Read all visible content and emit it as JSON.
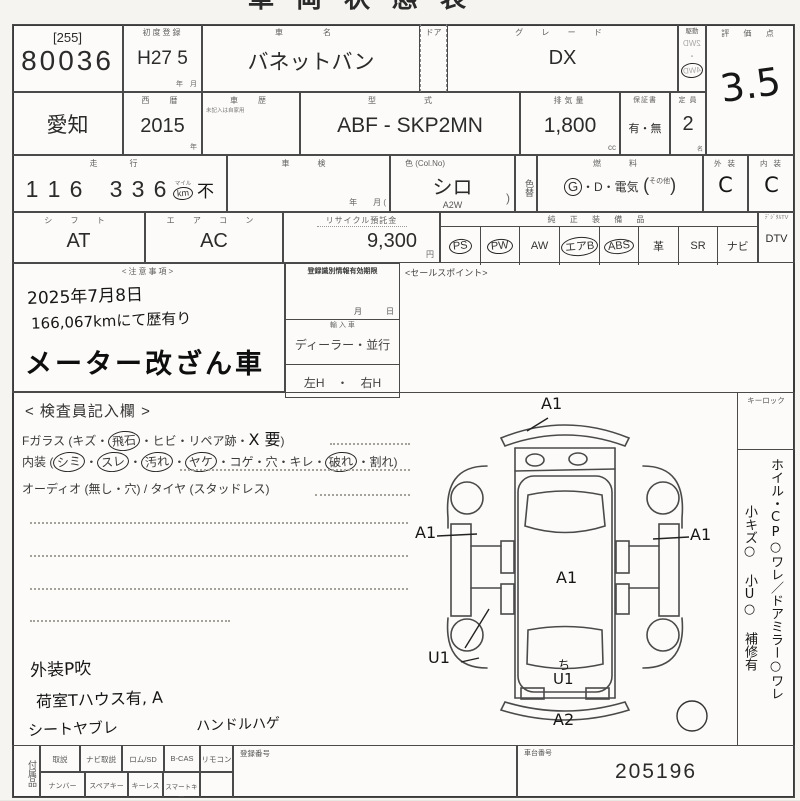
{
  "title": "車両状態表",
  "lot": {
    "tag": "[255]",
    "number": "80036"
  },
  "first_reg": {
    "label": "初度登録",
    "value": "H27 5",
    "unit": "年　月"
  },
  "car": {
    "name_label": "車　名",
    "name": "バネットバン",
    "door_label": "ドア",
    "grade_label": "グ レ ー ド",
    "grade": "DX"
  },
  "drive": {
    "label": "駆動",
    "opt1": "2WD",
    "sep": "・",
    "opt2": "4WD"
  },
  "score": {
    "label": "評 価 点",
    "value": "3.5"
  },
  "row2": {
    "prefecture": "愛知",
    "year_label": "西　暦",
    "year": "2015",
    "year_unit": "年",
    "history_label": "車　歴",
    "history_note": "未記入は自家用",
    "model_label": "型　式",
    "model": "ABF - SKP2MN",
    "disp_label": "排気量",
    "disp": "1,800",
    "disp_unit": "cc",
    "warranty_label": "保証書",
    "warranty": "有・無",
    "capacity_label": "定 員",
    "capacity": "2",
    "capacity_unit": "名"
  },
  "row3": {
    "mileage_label": "走　行",
    "digits": [
      "1",
      "1",
      "6",
      "3",
      "3",
      "6"
    ],
    "mile_top": "マイル",
    "mile_unit": "km",
    "mile_mark": "不",
    "shaken_label": "車　検",
    "shaken_unit": "年　　月 (",
    "color_label": "色 (Col.No)",
    "color": "シロ",
    "color_no": "A2W",
    "color_paren": ")",
    "color_change": "色替",
    "fuel_label": "燃　料",
    "fuel_g": "G",
    "fuel_rest": "・D・電気",
    "fuel_open": "(",
    "fuel_other": "その他",
    "fuel_close": ")",
    "ext_label": "外 装",
    "ext": "C",
    "int_label": "内 装",
    "int": "C"
  },
  "row4": {
    "shift_label": "シ フ ト",
    "shift": "AT",
    "ac_label": "エ ア コ ン",
    "ac": "AC",
    "recycle_label": "リサイクル預託金",
    "recycle": "9,300",
    "recycle_unit": "円",
    "equip_label": "純 正 装 備 品",
    "equip": [
      {
        "label": "PS",
        "circled": true
      },
      {
        "label": "PW",
        "circled": true
      },
      {
        "label": "AW",
        "circled": false
      },
      {
        "label": "エアB",
        "circled": true
      },
      {
        "label": "ABS",
        "circled": true
      },
      {
        "label": "革",
        "circled": false
      },
      {
        "label": "SR",
        "circled": false
      },
      {
        "label": "ナビ",
        "circled": false
      }
    ],
    "dtv_head": "ﾃﾞｼﾞﾀﾙTV",
    "dtv": "DTV"
  },
  "notes": {
    "label": "<注意事項>",
    "line1": "2025年7月8日",
    "line2": "166,067kmにて歴有り",
    "stamp": "メーター改ざん車"
  },
  "reg_info": {
    "title": "登録識別情報有効期限",
    "date_unit": "月　　　日",
    "import_label": "輸 入 車",
    "dealer": "ディーラー・並行",
    "handle": "左H　・　右H"
  },
  "sales_point_label": "<セールスポイント>",
  "inspector": {
    "title": "< 検査員記入欄 >",
    "glass_1": "Fガラス (キズ・",
    "glass_c": "飛石",
    "glass_2": "・ヒビ・リペア跡・",
    "glass_hand": "X 要",
    "glass_3": ")",
    "int_1": "内装 (",
    "int_c1": "シミ",
    "int_d1": "・",
    "int_c2": "スレ",
    "int_d2": "・",
    "int_c3": "汚れ",
    "int_d3": "・",
    "int_c4": "ヤケ",
    "int_2": "・コゲ・穴・キレ・",
    "int_c5": "破れ",
    "int_3": "・割れ)",
    "audio": "オーディオ (無し・穴) / タイヤ (スタッドレス)"
  },
  "hand_notes": {
    "line1": "外装P吹",
    "line2": "荷室Tハウス有, A",
    "line3": "シートヤブレ",
    "line4": "ハンドルハゲ"
  },
  "diagram": {
    "mark_top": "A1",
    "mark_left": "A1",
    "mark_right": "A1",
    "mark_center": "A1",
    "mark_lower_left": "U1",
    "mark_squiggle": "ち",
    "mark_bottom_center": "U1",
    "mark_rear": "A2"
  },
  "sidebar": {
    "keylock": "キーロック",
    "note_col1": "ホイル・CP○ワレ／ドアミラー○ワレ",
    "note_col2": "小キズ○ 小U○ 補修有"
  },
  "bottom": {
    "acc_label": "付属品",
    "cells_top": [
      "取説",
      "ナビ取説",
      "ロム/SD",
      "B-CAS",
      "リモコン"
    ],
    "reg_no_label": "登録番号",
    "cells_bottom": [
      "ナンバー",
      "スペアキー",
      "キーレス",
      "スマートキー"
    ],
    "chassis_label": "車台番号",
    "chassis": "205196"
  },
  "colors": {
    "ink": "#3a3a3a",
    "hand_ink": "#161616",
    "paper": "#fcfbf9"
  }
}
